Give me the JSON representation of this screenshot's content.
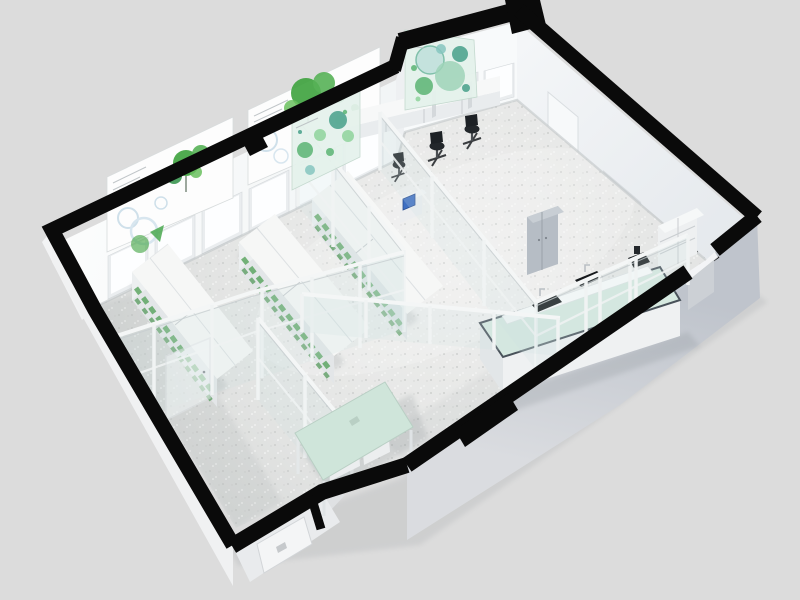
{
  "scene": {
    "kind": "isometric-3d-lab-floor-plan-render",
    "rooms": [
      "plant-grow-lab",
      "glass-office",
      "wet-lab-area",
      "entry-vestibule"
    ]
  },
  "palette": {
    "background": "#dcdcdc",
    "wall_cut_black": "#0a0a0a",
    "floor_base": "#e6e7e6",
    "nw_wall_white": "#f8fafb",
    "ne_wall_white": "#eef1f3",
    "sw_exterior": "#f0f1f2",
    "se_exterior": "#c6cad2",
    "vestibule_face": "#e9ebed",
    "door_white": "#f4f5f6",
    "glass_tint": "#cfe0e2",
    "frame_white": "#f4f6f6",
    "poster_white": "#fdfdfd",
    "poster_green": "#3da23d",
    "petri_panel": "#e5f2ec",
    "petri_green": "#5ab473",
    "petri_teal": "#86c5c0",
    "bench_white": "#f6f7f6",
    "plant_green": "#55a25b",
    "island_top_mint": "#d6e9e0",
    "island_rim": "#49525a",
    "table_mint": "#cfe5da",
    "chair_black": "#23272b",
    "cabinet_gray": "#b6bdc5",
    "wall_panel_dark": "#5d636b",
    "device_screen_blue": "#3e6fc2",
    "sink_black": "#15181b"
  },
  "inventory": {
    "botanical_posters": 2,
    "petri_dish_posters": 2,
    "back_wall_windows": 9,
    "exterior_windows": 2,
    "grow_bench_rows": 3,
    "office_chairs": 3,
    "sinks_on_island": 2,
    "island_benches": 1,
    "meeting_tables": 1,
    "doors": 4,
    "storage_cabinets": 2,
    "devices_with_screen": 1
  }
}
